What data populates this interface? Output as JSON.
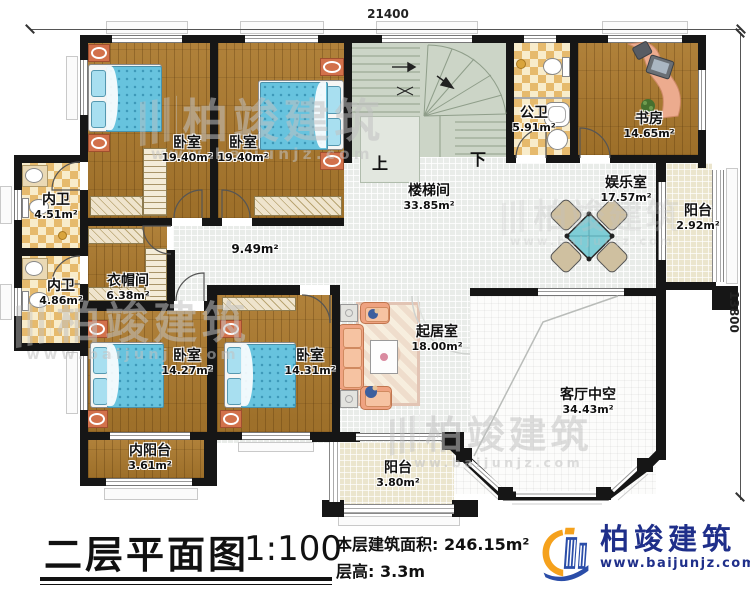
{
  "dimensions": {
    "width_mm": "21400",
    "height_mm": "13800"
  },
  "rooms": [
    {
      "id": "bedroom-top-left",
      "name": "卧室",
      "area": "19.40m²"
    },
    {
      "id": "bedroom-top-mid",
      "name": "卧室",
      "area": "19.40m²"
    },
    {
      "id": "public-bath",
      "name": "公卫",
      "area": "5.91m²"
    },
    {
      "id": "study",
      "name": "书房",
      "area": "14.65m²"
    },
    {
      "id": "stair-hall",
      "name": "楼梯间",
      "area": "33.85m²"
    },
    {
      "id": "entertainment-room",
      "name": "娱乐室",
      "area": "17.57m²"
    },
    {
      "id": "balcony-right",
      "name": "阳台",
      "area": "2.92m²"
    },
    {
      "id": "inner-bath-1",
      "name": "内卫",
      "area": "4.51m²"
    },
    {
      "id": "inner-bath-2",
      "name": "内卫",
      "area": "4.86m²"
    },
    {
      "id": "cloakroom",
      "name": "衣帽间",
      "area": "6.38m²"
    },
    {
      "id": "bedroom-bottom-left",
      "name": "卧室",
      "area": "14.27m²"
    },
    {
      "id": "bedroom-bottom-mid",
      "name": "卧室",
      "area": "14.31m²"
    },
    {
      "id": "inner-balcony",
      "name": "内阳台",
      "area": "3.61m²"
    },
    {
      "id": "sitting-room",
      "name": "起居室",
      "area": "18.00m²"
    },
    {
      "id": "living-void",
      "name": "客厅中空",
      "area": "34.43m²"
    },
    {
      "id": "balcony-bottom",
      "name": "阳台",
      "area": "3.80m²"
    }
  ],
  "corridor_area": "9.49m²",
  "stairs": {
    "up_label": "上",
    "down_label": "下"
  },
  "title_block": {
    "title": "二层平面图",
    "scale": "1:100",
    "area_label": "本层建筑面积:",
    "area_value": "246.15m²",
    "height_label": "层高:",
    "height_value": "3.3m"
  },
  "logo": {
    "name": "柏竣建筑",
    "url": "www.baijunjz.com"
  },
  "watermark": {
    "name": "柏竣建筑",
    "url": "www.baijunjz.com"
  },
  "colors": {
    "wall": "#161616",
    "wood_floor": "#a5772e",
    "tile": "#e6ba6d",
    "stair_floor": "#ccd5c7",
    "bed_blanket": "#67c3de",
    "logo_blue": "#1f2f8a",
    "logo_orange": "#f5a11c"
  }
}
